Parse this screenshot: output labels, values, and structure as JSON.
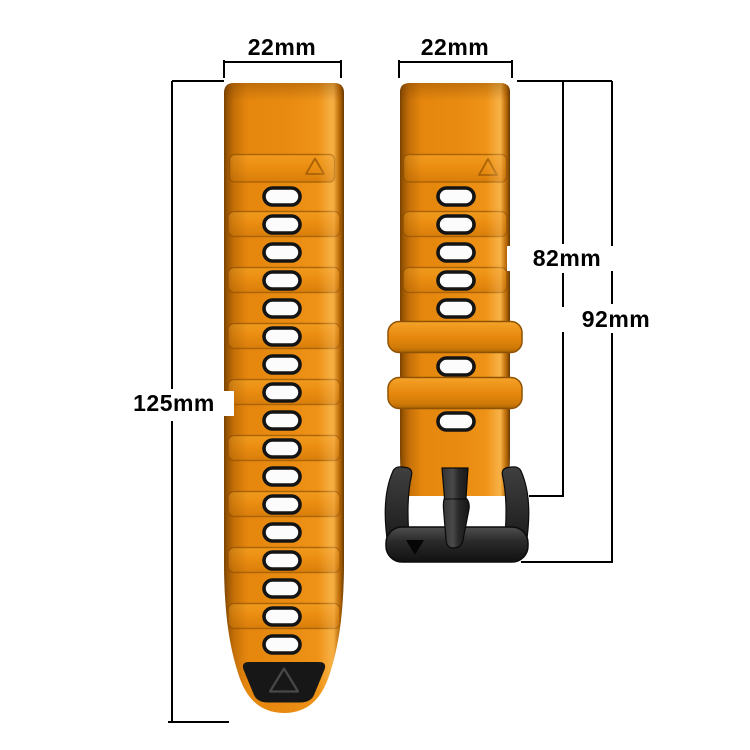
{
  "dimensions": {
    "left_strap_width": "22mm",
    "right_strap_width": "22mm",
    "left_strap_length": "125mm",
    "right_strap_length_without_buckle": "82mm",
    "right_strap_length_with_buckle": "92mm"
  },
  "left_strap": {
    "color_name": "orange",
    "hole_count": 17,
    "tip": "black-rubber-tip",
    "triangle_marker": true
  },
  "right_strap": {
    "color_name": "orange",
    "hole_count": 7,
    "keeper_loop_count": 2,
    "buckle": "black-metal-buckle",
    "triangle_marker": true
  },
  "colors": {
    "strap_orange": "#E8880E",
    "strap_orange_highlight": "#F5A127",
    "strap_orange_shadow": "#A86205",
    "hole_fill": "#FCFCFC",
    "hole_border": "#141414",
    "tip_black": "#171717",
    "buckle_black": "#262626",
    "dimension_line": "#000000",
    "background": "#FFFFFF"
  }
}
